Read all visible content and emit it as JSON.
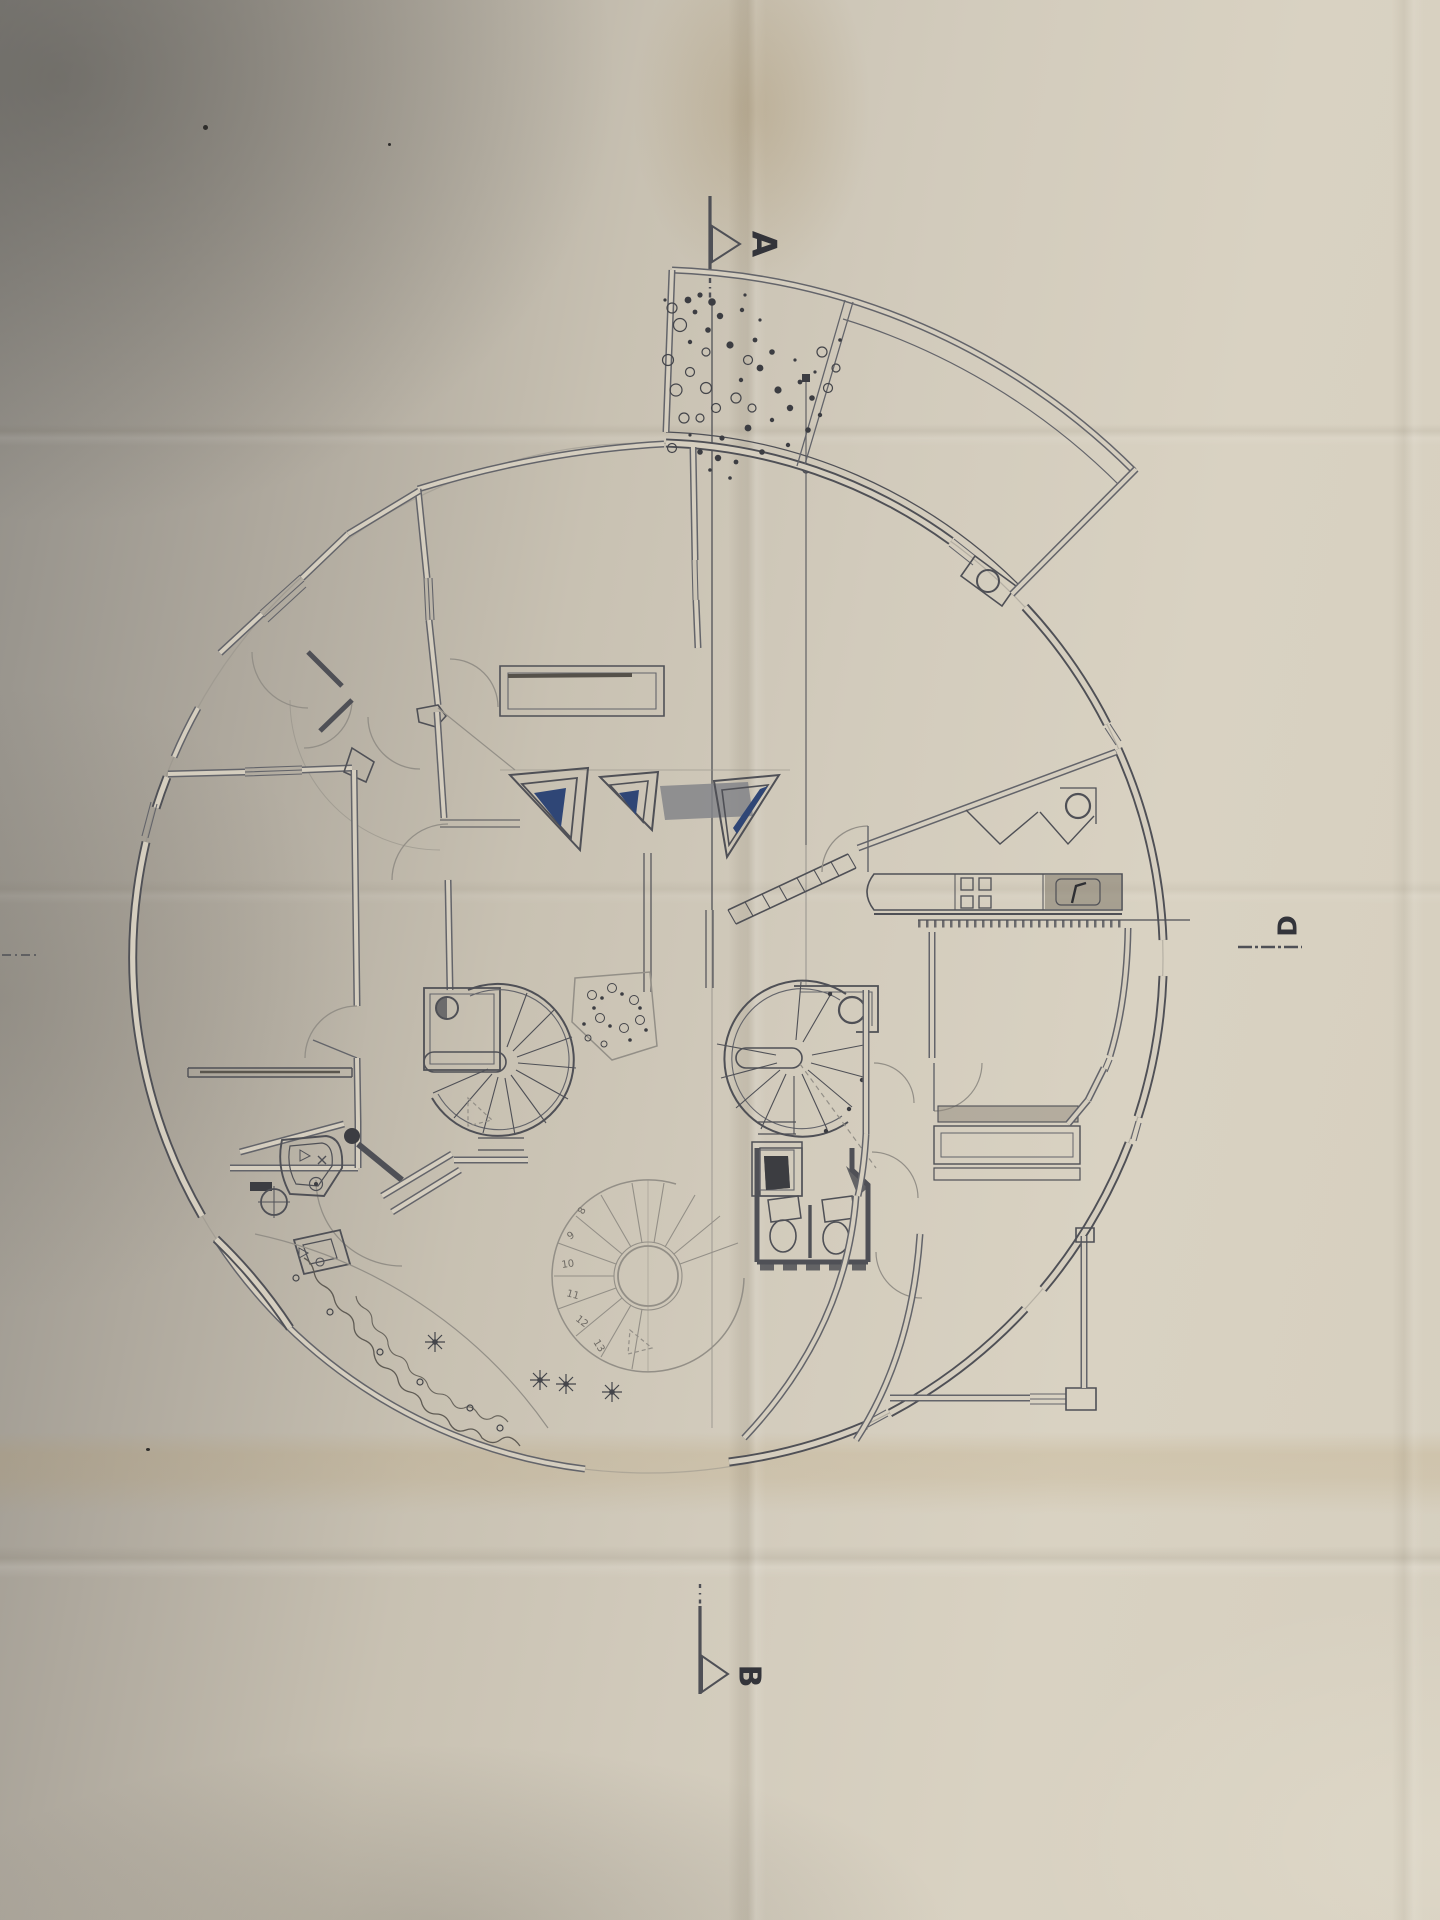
{
  "markers": {
    "section_a": "A",
    "section_b": "B",
    "section_d": "D"
  },
  "lower_spiral_stair_step_numbers": [
    "8",
    "9",
    "10",
    "11",
    "12",
    "13"
  ],
  "colors": {
    "paper-light": "#d9d2c2",
    "paper-mid": "#c8c1b2",
    "paper-dark": "#8f8c86",
    "wallfill": "#d5cebf",
    "ink": "#4f5056",
    "ink-soft": "#63646a",
    "pencil": "#938f87",
    "blue": "#2f4676",
    "gray-fill": "#84858a",
    "stain": "#b09a66"
  }
}
